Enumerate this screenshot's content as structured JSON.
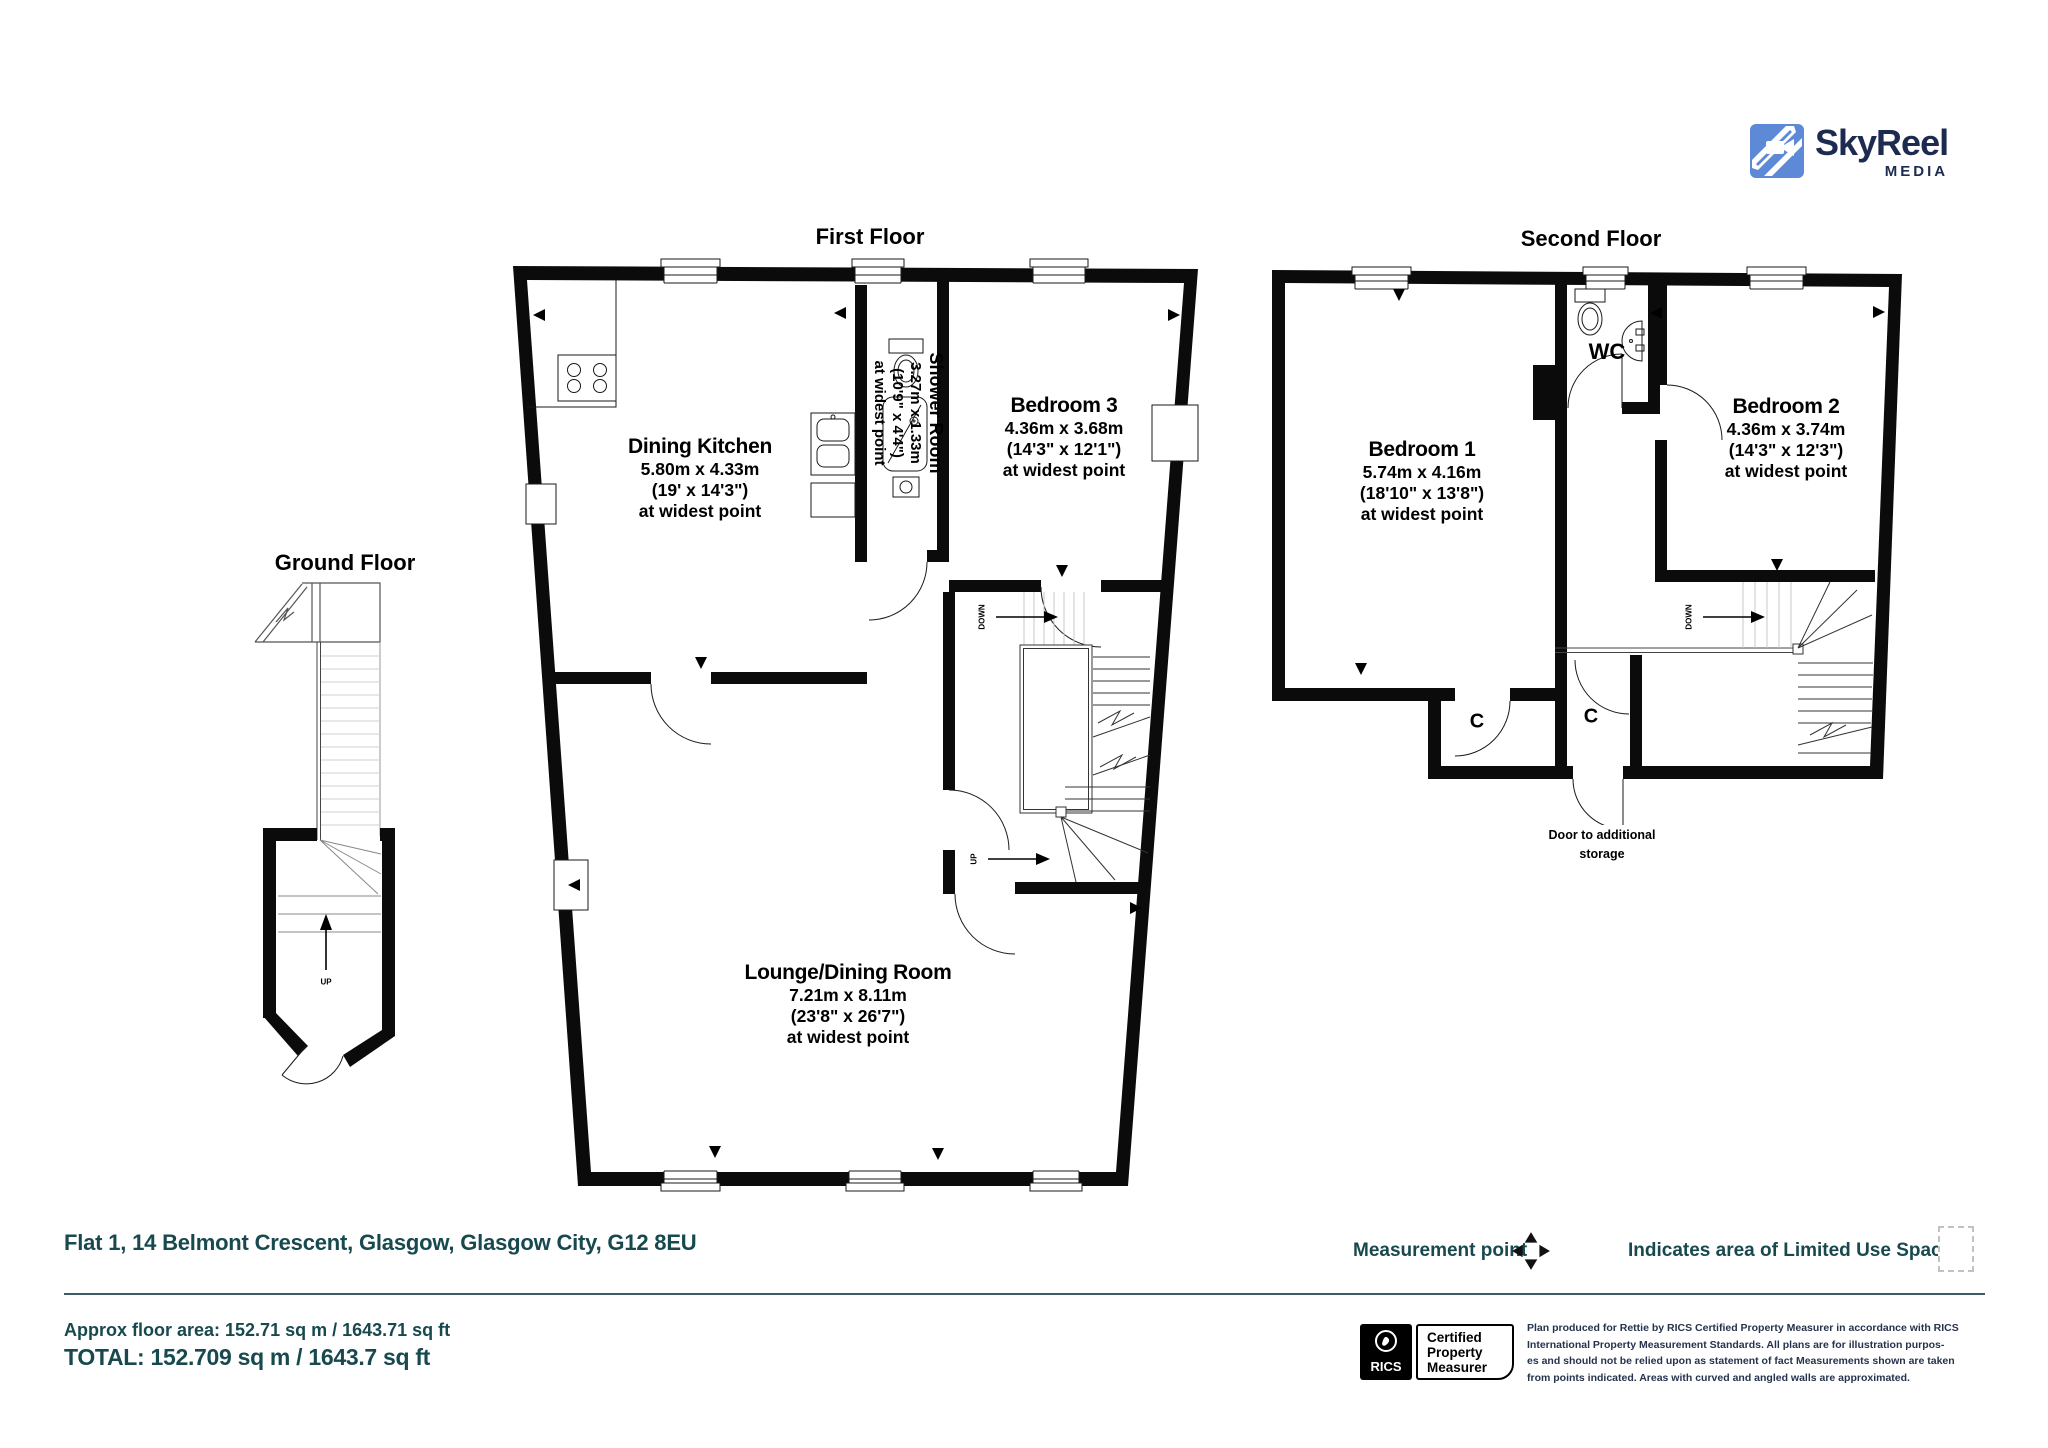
{
  "logo": {
    "name": "SkyReel",
    "sub": "MEDIA"
  },
  "floors": {
    "ground": {
      "title": "Ground Floor",
      "stair_up": "UP"
    },
    "first": {
      "title": "First Floor",
      "stair_down": "DOWN",
      "stair_up": "UP",
      "rooms": {
        "dining_kitchen": {
          "name": "Dining Kitchen",
          "dims_m": "5.80m x 4.33m",
          "dims_ft": "(19' x 14'3\")",
          "note": "at widest point"
        },
        "shower_room": {
          "name": "Shower Room",
          "dims_m": "3.27m x 1.33m",
          "dims_ft": "(10'9\" x 4'4\")",
          "note": "at widest point"
        },
        "bedroom3": {
          "name": "Bedroom 3",
          "dims_m": "4.36m x 3.68m",
          "dims_ft": "(14'3\" x 12'1\")",
          "note": "at widest point"
        },
        "lounge": {
          "name": "Lounge/Dining Room",
          "dims_m": "7.21m x 8.11m",
          "dims_ft": "(23'8\" x 26'7\")",
          "note": "at widest point"
        }
      }
    },
    "second": {
      "title": "Second Floor",
      "stair_down": "DOWN",
      "wc": "WC",
      "closet1": "C",
      "closet2": "C",
      "storage_line1": "Door to additional",
      "storage_line2": "storage",
      "rooms": {
        "bedroom1": {
          "name": "Bedroom 1",
          "dims_m": "5.74m x 4.16m",
          "dims_ft": "(18'10\" x 13'8\")",
          "note": "at widest point"
        },
        "bedroom2": {
          "name": "Bedroom 2",
          "dims_m": "4.36m x 3.74m",
          "dims_ft": "(14'3\" x 12'3\")",
          "note": "at widest point"
        }
      }
    }
  },
  "footer": {
    "address": "Flat 1, 14 Belmont Crescent, Glasgow, Glasgow City, G12 8EU",
    "measurement_point": "Measurement point",
    "limited_use": "Indicates area of  Limited Use Space",
    "approx_area": "Approx floor area: 152.71 sq m / 1643.71 sq ft",
    "total": "TOTAL: 152.709 sq m / 1643.7 sq ft",
    "rics": "RICS",
    "certified": [
      "Certified",
      "Property",
      "Measurer"
    ],
    "disclaimer": [
      "Plan produced for Rettie by RICS Certified Property Measurer in accordance with RICS",
      "International Property  Measurement Standards.  All plans are for illustration purpos-",
      "es and should not be relied upon as statement of fact Measurements shown are taken",
      "from points indicated. Areas with curved and angled walls are approximated."
    ]
  },
  "colors": {
    "teal": "#17494e",
    "navy": "#1d2b50",
    "logo_blue": "#5d89d6",
    "wall": "#0b0b0b"
  }
}
